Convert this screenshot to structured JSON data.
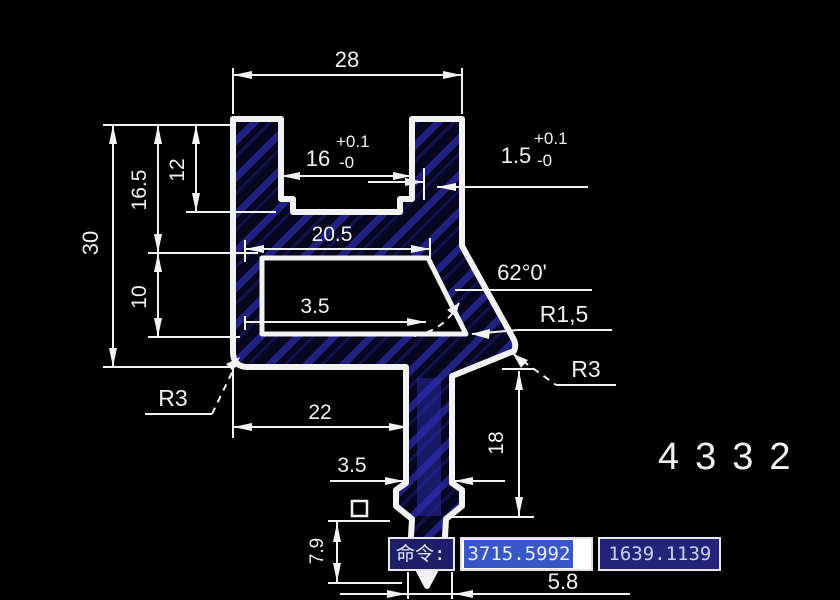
{
  "drawing": {
    "part_number": "4332",
    "dims": {
      "width_top": "28",
      "slot_width": "16",
      "slot_tol_plus": "+0.1",
      "slot_tol_minus": "-0",
      "lip_width": "1.5",
      "lip_tol_plus": "+0.1",
      "lip_tol_minus": "-0",
      "height_total": "30",
      "height_16_5": "16.5",
      "height_12": "12",
      "height_10": "10",
      "cavity_width": "20.5",
      "wall_upper": "3.5",
      "angle": "62°0'",
      "radius_small": "R1,5",
      "radius_right": "R3",
      "radius_left": "R3",
      "width_bottom": "22",
      "wall_lower": "3.5",
      "leg_height": "18",
      "tip_height": "7.9",
      "leg_width": "5.8"
    }
  },
  "command_bar": {
    "label": "命令:",
    "x_value": "3715.5992",
    "y_value": "1639.1139"
  }
}
